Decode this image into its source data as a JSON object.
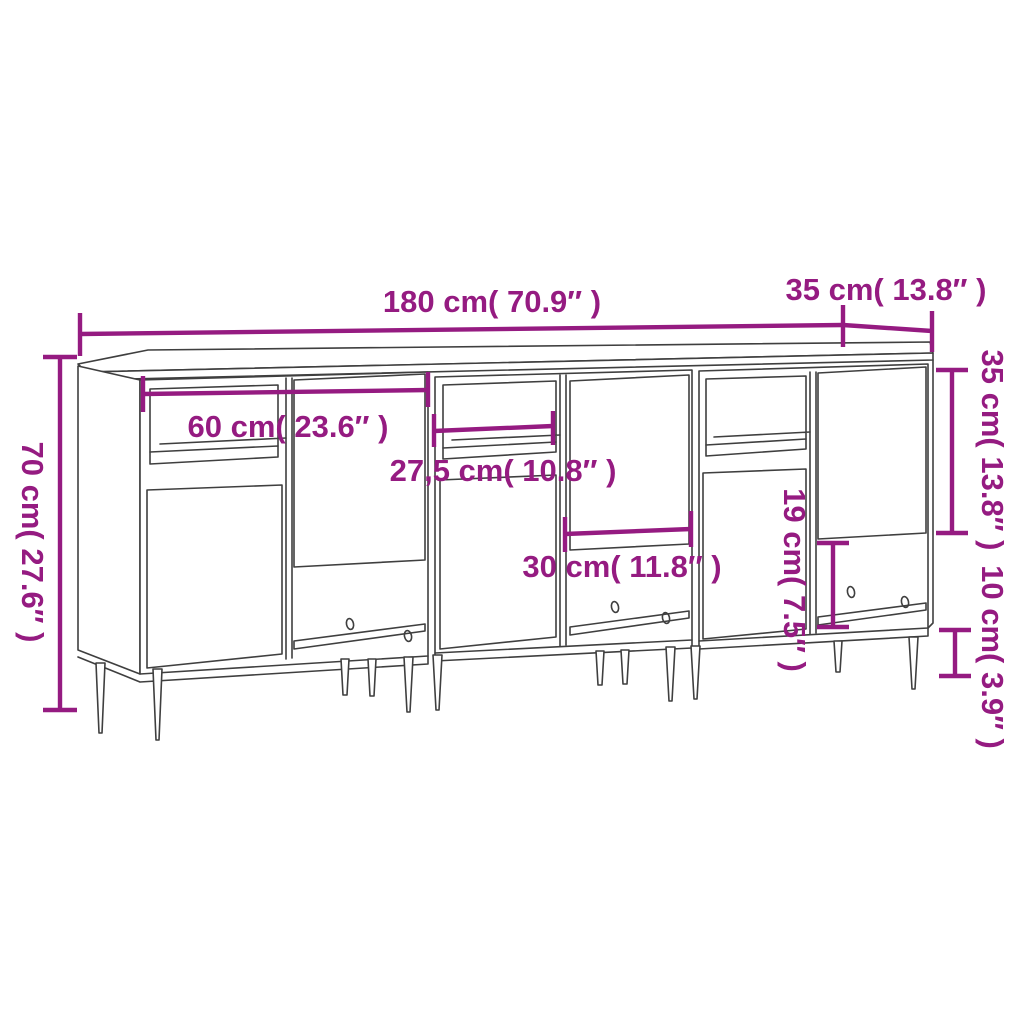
{
  "diagram": {
    "title": "3-piece sideboard set dimension drawing",
    "colors": {
      "accent": "#951b81",
      "outline": "#3f3f3f",
      "background": "#ffffff"
    },
    "labels": {
      "total_width": "180 cm( 70.9″ )",
      "depth": "35 cm( 13.8″ )",
      "total_height": "70 cm( 27.6″ )",
      "unit_interior_width": "60 cm( 23.6″ )",
      "shelf_width": "27,5 cm( 10.8″ )",
      "door_width": "30 cm( 11.8″ )",
      "open_compartment_height": "19 cm( 7.5″ )",
      "door_height": "35 cm( 13.8″ )",
      "leg_height": "10 cm( 3.9″ )"
    },
    "dimensions": [
      {
        "id": "total-width",
        "cm": 180,
        "inches": 70.9,
        "text": "180 cm( 70.9″ )",
        "orientation": "horizontal"
      },
      {
        "id": "depth",
        "cm": 35,
        "inches": 13.8,
        "text": "35 cm( 13.8″ )",
        "orientation": "horizontal"
      },
      {
        "id": "total-height",
        "cm": 70,
        "inches": 27.6,
        "text": "70 cm( 27.6″ )",
        "orientation": "vertical"
      },
      {
        "id": "unit-interior-width",
        "cm": 60,
        "inches": 23.6,
        "text": "60 cm( 23.6″ )",
        "orientation": "horizontal"
      },
      {
        "id": "shelf-width",
        "cm": 27.5,
        "inches": 10.8,
        "text": "27,5 cm( 10.8″ )",
        "orientation": "horizontal"
      },
      {
        "id": "door-width",
        "cm": 30,
        "inches": 11.8,
        "text": "30 cm( 11.8″ )",
        "orientation": "horizontal"
      },
      {
        "id": "open-compartment-height",
        "cm": 19,
        "inches": 7.5,
        "text": "19 cm( 7.5″ )",
        "orientation": "vertical"
      },
      {
        "id": "door-height",
        "cm": 35,
        "inches": 13.8,
        "text": "35 cm( 13.8″ )",
        "orientation": "vertical"
      },
      {
        "id": "leg-height",
        "cm": 10,
        "inches": 3.9,
        "text": "10 cm( 3.9″ )",
        "orientation": "vertical"
      }
    ]
  }
}
